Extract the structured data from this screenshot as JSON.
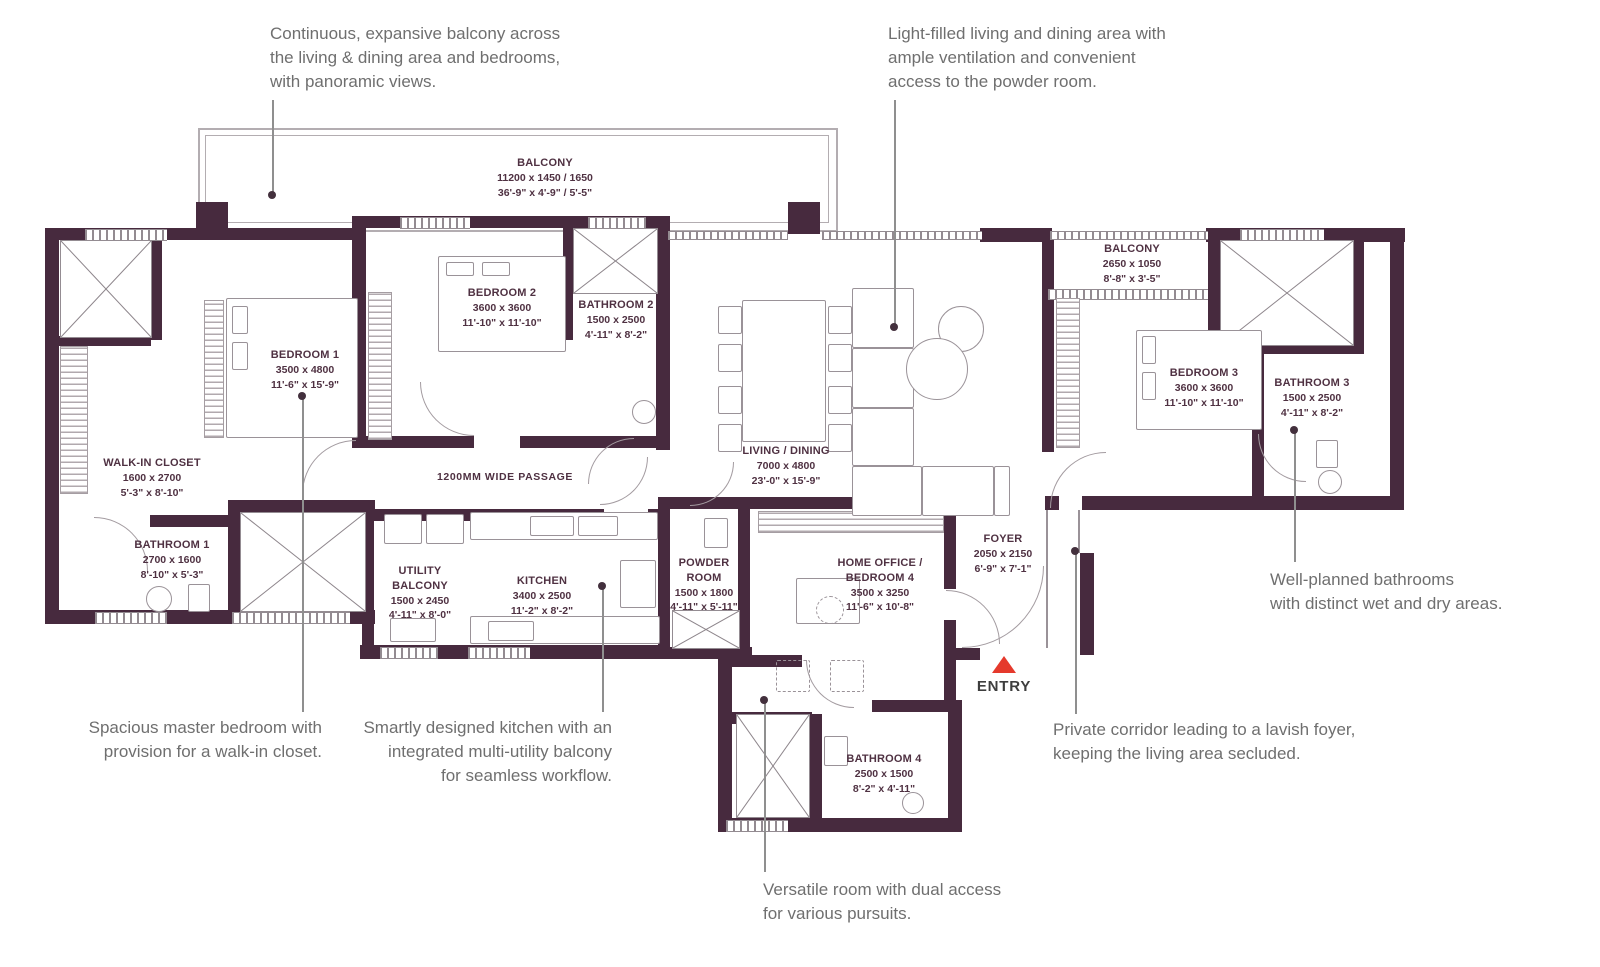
{
  "colors": {
    "wall": "#472a3e",
    "entry_accent": "#e5392c",
    "note_text": "#6f6f6f",
    "plan_text": "#4f3142"
  },
  "notes": {
    "balcony": "Continuous, expansive balcony across\nthe living & dining area and bedrooms,\nwith panoramic views.",
    "living": "Light-filled living and dining area with\nample ventilation and convenient\naccess to the powder room.",
    "master": "Spacious master bedroom with\nprovision for a walk-in closet.",
    "kitchen": "Smartly designed kitchen with an\nintegrated multi-utility balcony\nfor seamless workflow.",
    "versatile": "Versatile room with dual access\nfor various pursuits.",
    "corridor": "Private corridor leading to a lavish foyer,\nkeeping the living area secluded.",
    "bathrooms": "Well-planned bathrooms\nwith distinct wet and dry areas."
  },
  "rooms": [
    {
      "name": "BALCONY",
      "metric": "11200 x 1450 / 1650",
      "imperial": "36'-9\" x 4'-9\" / 5'-5\""
    },
    {
      "name": "BEDROOM 1",
      "metric": "3500 x 4800",
      "imperial": "11'-6\" x 15'-9\""
    },
    {
      "name": "BEDROOM 2",
      "metric": "3600 x 3600",
      "imperial": "11'-10\" x 11'-10\""
    },
    {
      "name": "BATHROOM 2",
      "metric": "1500 x 2500",
      "imperial": "4'-11\" x 8'-2\""
    },
    {
      "name": "LIVING / DINING",
      "metric": "7000 x 4800",
      "imperial": "23'-0\" x 15'-9\""
    },
    {
      "name": "BALCONY",
      "metric": "2650 x 1050",
      "imperial": "8'-8\" x 3'-5\""
    },
    {
      "name": "BEDROOM 3",
      "metric": "3600 x 3600",
      "imperial": "11'-10\" x 11'-10\""
    },
    {
      "name": "BATHROOM 3",
      "metric": "1500 x 2500",
      "imperial": "4'-11\" x 8'-2\""
    },
    {
      "name": "WALK-IN CLOSET",
      "metric": "1600 x 2700",
      "imperial": "5'-3\" x 8'-10\""
    },
    {
      "name": "BATHROOM 1",
      "metric": "2700 x 1600",
      "imperial": "8'-10\" x 5'-3\""
    },
    {
      "name": "UTILITY BALCONY",
      "metric": "1500 x 2450",
      "imperial": "4'-11\" x 8'-0\""
    },
    {
      "name": "KITCHEN",
      "metric": "3400 x 2500",
      "imperial": "11'-2\" x 8'-2\""
    },
    {
      "name": "POWDER ROOM",
      "metric": "1500 x 1800",
      "imperial": "4'-11\" x 5'-11\""
    },
    {
      "name": "HOME OFFICE / BEDROOM 4",
      "metric": "3500 x 3250",
      "imperial": "11'-6\" x 10'-8\""
    },
    {
      "name": "FOYER",
      "metric": "2050 x 2150",
      "imperial": "6'-9\" x 7'-1\""
    },
    {
      "name": "BATHROOM 4",
      "metric": "2500 x 1500",
      "imperial": "8'-2\" x 4'-11\""
    }
  ],
  "passage_label": "1200MM WIDE PASSAGE",
  "entry_label": "ENTRY"
}
